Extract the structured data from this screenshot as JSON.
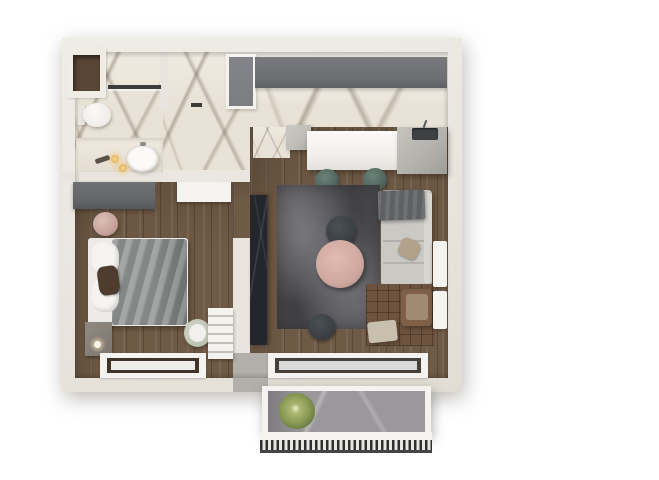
{
  "meta": {
    "description": "3D top-down architectural render of a one-bedroom apartment floor plan with balcony",
    "background": "#ffffff",
    "visible_text": ""
  },
  "colors": {
    "wall": "#e9e5de",
    "wall_light": "#f0ede7",
    "wall_shadow": "#cfc9bf",
    "marble_base": "#e9e2d6",
    "marble_black": "#23272c",
    "wood": "#6f5a45",
    "cabinet_gray": "#6d6f72",
    "door_gray": "#7b7d80",
    "island_gray": "#bfbdb8",
    "counter_white": "#f2f0ec",
    "sink_dark": "#3e4245",
    "stool_teal": "#53675f",
    "rug_base": "#5d5d60",
    "table_pink": "#cfa89f",
    "dark_round": "#3b3f43",
    "sofa_gray": "#cbc9c4",
    "throw_gray": "#5e6064",
    "chair_brown": "#7e6049",
    "cushion_tan": "#a08b72",
    "mat_brown": "#6e533e",
    "ottoman_beige": "#c9bfae",
    "bed_white": "#edebe7",
    "blanket_gray": "#909292",
    "pillow_dark": "#4e3c2e",
    "wardrobe_gray": "#646669",
    "pouf_pink": "#c7a29b",
    "white_trim": "#f5f3ef",
    "glass_gray": "#d8dbda",
    "balcony_floor": "#9b989b",
    "plant_green": "#8a9a55",
    "railing_dark": "#2f2f2f",
    "concrete_gray": "#b3afaa",
    "lamp_warm": "#f0d9a6"
  },
  "rooms": [
    {
      "name": "bathroom",
      "items": [
        "built-in-closet",
        "shower",
        "toilet",
        "vanity-sink",
        "candles"
      ]
    },
    {
      "name": "hallway",
      "items": [
        "entry-door"
      ]
    },
    {
      "name": "kitchen",
      "items": [
        "upper-cabinet-run",
        "island-counter",
        "kitchen-sink",
        "bar-stool-1",
        "bar-stool-2"
      ]
    },
    {
      "name": "bedroom",
      "items": [
        "wardrobe",
        "open-door",
        "pink-pouf",
        "double-bed",
        "pillows",
        "gray-blanket",
        "nightstand",
        "table-lamp",
        "round-chair",
        "shelf-unit",
        "window"
      ]
    },
    {
      "name": "living-room",
      "items": [
        "tv-marble-panel",
        "area-rug",
        "round-coffee-table",
        "round-side-table",
        "floor-pouf",
        "sofa",
        "throw-blanket",
        "armchair",
        "ottoman",
        "quilted-mat",
        "radiator",
        "balcony-door"
      ]
    },
    {
      "name": "balcony",
      "items": [
        "potted-plant",
        "railing"
      ]
    }
  ]
}
